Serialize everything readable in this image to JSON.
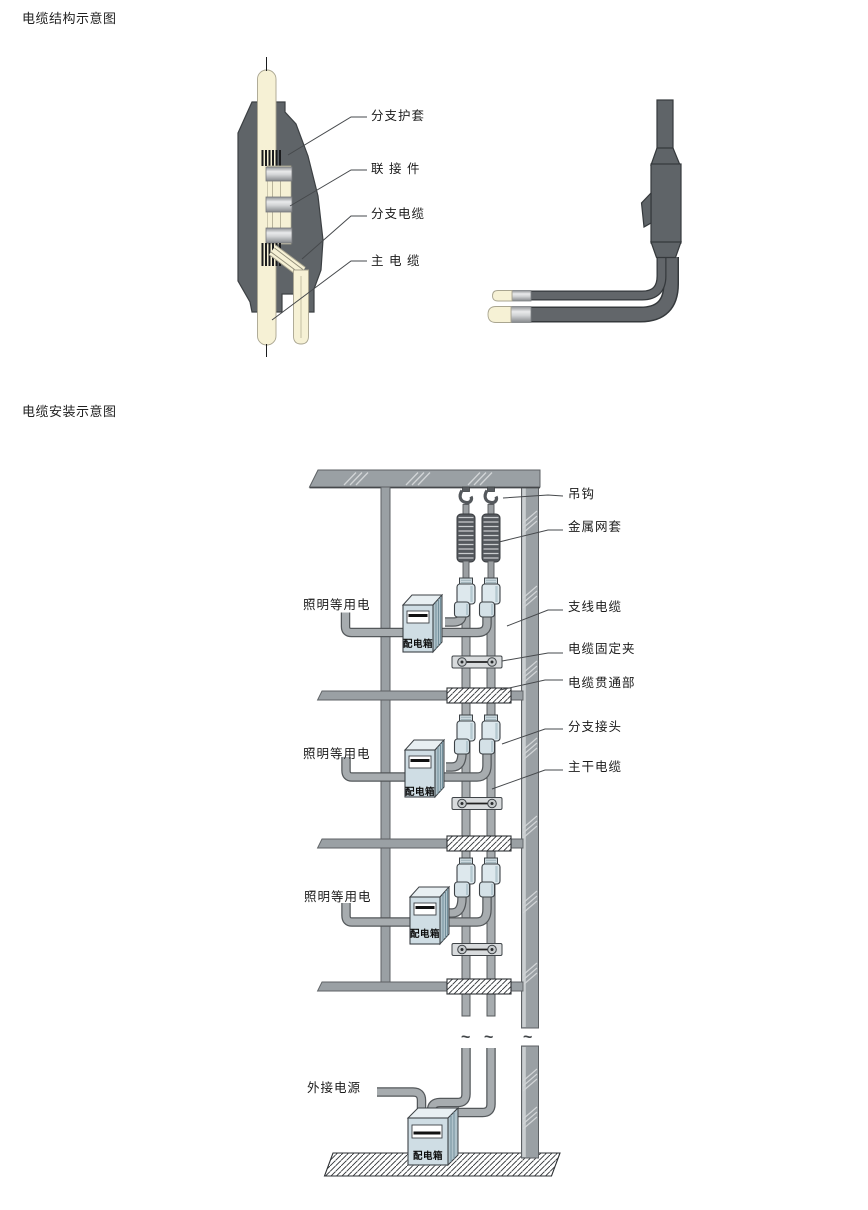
{
  "structure_section": {
    "title": "电缆结构示意图",
    "labels": [
      {
        "id": "branch-sheath",
        "text": "分支护套"
      },
      {
        "id": "connector",
        "text": "联 接 件"
      },
      {
        "id": "branch-cable",
        "text": "分支电缆"
      },
      {
        "id": "main-cable",
        "text": "主 电 缆"
      }
    ]
  },
  "installation_section": {
    "title": "电缆安装示意图",
    "right_labels": [
      {
        "id": "hook",
        "text": "吊钩"
      },
      {
        "id": "metal-mesh-sleeve",
        "text": "金属网套"
      },
      {
        "id": "branch-line-cable",
        "text": "支线电缆"
      },
      {
        "id": "cable-fixing-clamp",
        "text": "电缆固定夹"
      },
      {
        "id": "cable-penetration",
        "text": "电缆贯通部"
      },
      {
        "id": "branch-joint",
        "text": "分支接头"
      },
      {
        "id": "main-trunk-cable",
        "text": "主干电缆"
      }
    ],
    "left_labels": [
      {
        "id": "lighting-load-1",
        "text": "照明等用电"
      },
      {
        "id": "lighting-load-2",
        "text": "照明等用电"
      },
      {
        "id": "lighting-load-3",
        "text": "照明等用电"
      },
      {
        "id": "external-power",
        "text": "外接电源"
      }
    ],
    "distribution_boxes": [
      {
        "label": "配电箱"
      },
      {
        "label": "配电箱"
      },
      {
        "label": "配电箱"
      },
      {
        "label": "配电箱"
      }
    ],
    "break_marks": [
      "~",
      "~",
      "~"
    ]
  },
  "colors": {
    "joint_body_gray": "#5f6468",
    "cable_cream": "#f6f1d5",
    "structure_gray": "#9aa0a4",
    "pipe_gray": "#a7acaf",
    "connector_blue": "#dde8ed",
    "box_blue": "#cfdde4"
  }
}
